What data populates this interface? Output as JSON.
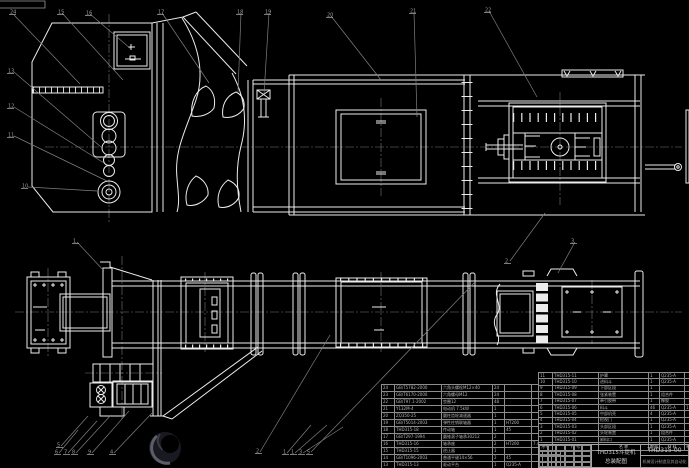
{
  "title_block": {
    "product": "THD315斗提机",
    "drawing_title": "总装配图",
    "drawing_no": "THD315-00",
    "organization": "机械设计制造及其自动化"
  },
  "bom_left": {
    "rows": [
      [
        "24",
        "GB/T5782-2000",
        "六角头螺栓M12×40",
        "24",
        "",
        "",
        "",
        ""
      ],
      [
        "23",
        "GB/T6170-2000",
        "六角螺母M12",
        "24",
        "",
        "",
        "",
        ""
      ],
      [
        "22",
        "GB/T97.1-2002",
        "垫圈12",
        "48",
        "",
        "",
        "",
        ""
      ],
      [
        "21",
        "Y132M-4",
        "电动机 7.5kW",
        "1",
        "",
        "",
        "",
        ""
      ],
      [
        "20",
        "ZQ350-25",
        "圆柱齿轮减速器",
        "1",
        "",
        "",
        "",
        ""
      ],
      [
        "19",
        "GB/T5014-2003",
        "弹性柱销联轴器",
        "1",
        "HT200",
        "",
        "",
        ""
      ],
      [
        "18",
        "THD315-18",
        "传动轴",
        "1",
        "45",
        "",
        "",
        ""
      ],
      [
        "17",
        "GB/T297-1994",
        "圆锥滚子轴承30212",
        "2",
        "",
        "",
        "",
        ""
      ],
      [
        "16",
        "THD315-16",
        "轴承座",
        "2",
        "HT200",
        "7.4",
        "15",
        ""
      ],
      [
        "15",
        "THD315-15",
        "逆止器",
        "1",
        "",
        "",
        "",
        ""
      ],
      [
        "14",
        "GB/T1096-2003",
        "普通平键14×56",
        "2",
        "45",
        "",
        "",
        ""
      ],
      [
        "13",
        "THD315-13",
        "驱动平台",
        "1",
        "Q235-A",
        "",
        "",
        ""
      ],
      [
        "12",
        "THD315-12",
        "支承架",
        "1",
        "Q235-A",
        "",
        "",
        ""
      ]
    ]
  },
  "bom_right": {
    "rows": [
      [
        "11",
        "THD315-11",
        "护罩",
        "1",
        "Q235-A",
        "",
        "",
        ""
      ],
      [
        "10",
        "THD315-10",
        "进料斗",
        "1",
        "Q235-A",
        "",
        "",
        ""
      ],
      [
        "9",
        "THD315-09",
        "下部区段",
        "1",
        "",
        "",
        "",
        ""
      ],
      [
        "8",
        "THD315-08",
        "张紧装置",
        "1",
        "组合件",
        "",
        "",
        ""
      ],
      [
        "7",
        "THD315-07",
        "牵引胶带",
        "1",
        "橡胶",
        "",
        "",
        ""
      ],
      [
        "6",
        "THD315-06",
        "料斗",
        "46",
        "Q235-A",
        "1.2",
        "55",
        ""
      ],
      [
        "5",
        "THD315-05",
        "中部机壳",
        "4",
        "Q235-A",
        "",
        "",
        ""
      ],
      [
        "4",
        "THD315-04",
        "检视门",
        "1",
        "Q235-A",
        "",
        "",
        ""
      ],
      [
        "3",
        "THD315-03",
        "头部区段",
        "1",
        "Q235-A",
        "",
        "",
        ""
      ],
      [
        "2",
        "THD315-02",
        "头轮装置",
        "1",
        "组合件",
        "",
        "",
        ""
      ],
      [
        "1",
        "THD315-01",
        "卸料口",
        "1",
        "Q235-A",
        "",
        "",
        ""
      ],
      [
        "序号",
        "代 号",
        "名  称",
        "数量",
        "材 料",
        "单件",
        "总计",
        "备注"
      ]
    ]
  },
  "balloons": [
    {
      "n": "24",
      "x": 10,
      "y": 9
    },
    {
      "n": "15",
      "x": 58,
      "y": 9
    },
    {
      "n": "16",
      "x": 86,
      "y": 10
    },
    {
      "n": "17",
      "x": 158,
      "y": 9
    },
    {
      "n": "18",
      "x": 237,
      "y": 9
    },
    {
      "n": "19",
      "x": 265,
      "y": 9
    },
    {
      "n": "20",
      "x": 327,
      "y": 12
    },
    {
      "n": "21",
      "x": 410,
      "y": 8
    },
    {
      "n": "22",
      "x": 485,
      "y": 7
    },
    {
      "n": "13",
      "x": 8,
      "y": 68
    },
    {
      "n": "12",
      "x": 8,
      "y": 103
    },
    {
      "n": "11",
      "x": 8,
      "y": 132
    },
    {
      "n": "10",
      "x": 22,
      "y": 183
    },
    {
      "n": "1",
      "x": 73,
      "y": 238
    },
    {
      "n": "2",
      "x": 505,
      "y": 258
    },
    {
      "n": "3",
      "x": 571,
      "y": 238
    },
    {
      "n": "5",
      "x": 57,
      "y": 442
    },
    {
      "n": "6",
      "x": 55,
      "y": 449
    },
    {
      "n": "7",
      "x": 64,
      "y": 449
    },
    {
      "n": "8",
      "x": 72,
      "y": 449
    },
    {
      "n": "9",
      "x": 88,
      "y": 449
    },
    {
      "n": "4",
      "x": 110,
      "y": 449
    },
    {
      "n": "2",
      "x": 256,
      "y": 448
    },
    {
      "n": "1",
      "x": 283,
      "y": 449
    },
    {
      "n": "1",
      "x": 291,
      "y": 449
    },
    {
      "n": "3",
      "x": 299,
      "y": 449
    },
    {
      "n": "5",
      "x": 307,
      "y": 449
    }
  ],
  "leaders": [
    [
      14,
      15,
      80,
      84
    ],
    [
      62,
      13,
      123,
      80
    ],
    [
      90,
      14,
      131,
      49
    ],
    [
      162,
      13,
      209,
      83
    ],
    [
      241,
      13,
      238,
      92
    ],
    [
      269,
      13,
      264,
      94
    ],
    [
      331,
      16,
      381,
      80
    ],
    [
      414,
      12,
      417,
      117
    ],
    [
      489,
      11,
      537,
      97
    ],
    [
      14,
      72,
      101,
      147
    ],
    [
      14,
      107,
      104,
      163
    ],
    [
      14,
      136,
      107,
      181
    ],
    [
      28,
      187,
      97,
      191
    ],
    [
      77,
      242,
      104,
      271
    ],
    [
      510,
      261,
      545,
      213
    ],
    [
      575,
      242,
      558,
      273
    ],
    [
      61,
      446,
      88,
      416
    ],
    [
      59,
      453,
      78,
      430
    ],
    [
      68,
      453,
      97,
      421
    ],
    [
      76,
      453,
      111,
      415
    ],
    [
      92,
      453,
      129,
      411
    ],
    [
      114,
      453,
      152,
      413
    ],
    [
      260,
      452,
      330,
      335
    ],
    [
      311,
      452,
      475,
      282
    ],
    [
      287,
      453,
      311,
      425
    ],
    [
      295,
      453,
      327,
      425
    ],
    [
      303,
      453,
      343,
      427
    ]
  ],
  "colors": {
    "background": "#000000",
    "line": "#ececec",
    "annotation": "#7f7f7f",
    "table_text": "#b4b4b4",
    "watermark": "#22222b"
  }
}
